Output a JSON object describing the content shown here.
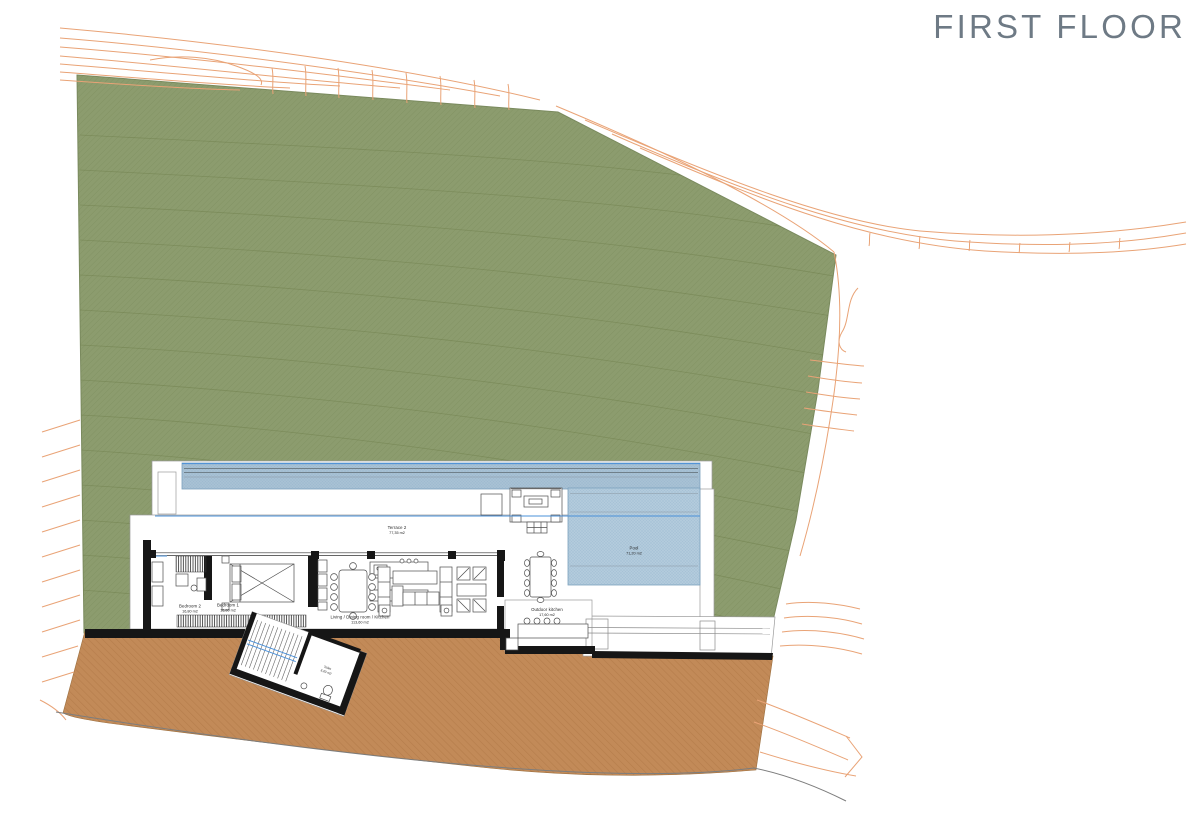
{
  "title": "FIRST FLOOR",
  "colors": {
    "title_text": "#6e7a85",
    "terrain_green": "#8c9c6e",
    "terrain_green_hatch": "#6f814d",
    "terrain_brown": "#c28a58",
    "terrain_brown_hatch": "#a56f3c",
    "contour_orange": "#e9a376",
    "site_line_gray": "#7d7d7d",
    "pool_fill": "#b3cbdc",
    "lap_pool_fill": "#a8c1d4",
    "pool_hatch": "#84a8c3",
    "accent_blue": "#4a90d9",
    "wall_black": "#161616"
  },
  "rooms": [
    {
      "name": "Terrace 2",
      "area": "77,35 m2"
    },
    {
      "name": "Pool",
      "area": "71,20 m2"
    },
    {
      "name": "Bedroom 2",
      "area": "16,80 m2"
    },
    {
      "name": "Bedroom 1",
      "area": "16,80 m2"
    },
    {
      "name": "Living / Dining room / Kitchen",
      "area": "113,60 m2"
    },
    {
      "name": "Outdoor kitchen",
      "area": "17,60 m2"
    },
    {
      "name": "Toilet",
      "area": "3,20 m2"
    }
  ]
}
